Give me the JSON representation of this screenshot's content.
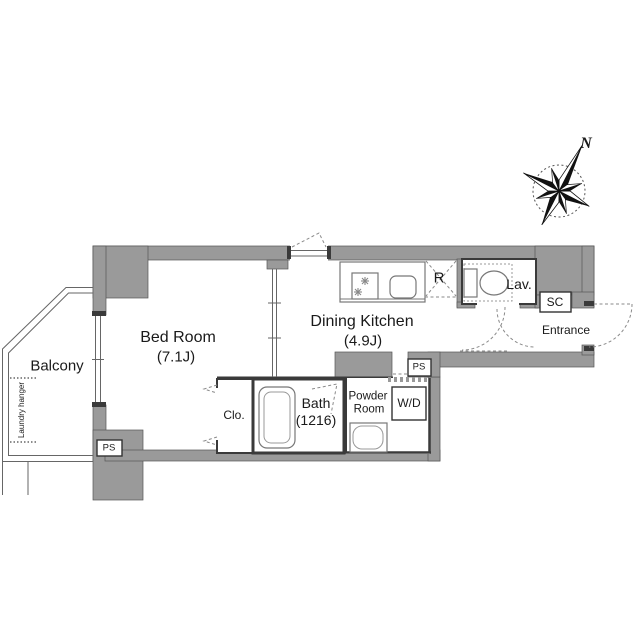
{
  "floorplan": {
    "rooms": {
      "bedroom": {
        "label": "Bed Room",
        "size": "(7.1J)"
      },
      "dining_kitchen": {
        "label": "Dining Kitchen",
        "size": "(4.9J)"
      },
      "bath": {
        "label": "Bath",
        "size": "(1216)"
      },
      "powder_room": {
        "label_line1": "Powder",
        "label_line2": "Room"
      },
      "balcony": {
        "label": "Balcony"
      },
      "lavatory": {
        "label": "Lav."
      },
      "entrance": {
        "label": "Entrance"
      },
      "closet": {
        "label": "Clo."
      }
    },
    "fixtures": {
      "washer_dryer": "W/D",
      "refrigerator": "R",
      "shoe_cabinet": "SC",
      "pipe_space": "PS",
      "laundry_hanger": "Laundry hanger"
    },
    "compass": {
      "north": "N"
    },
    "colors": {
      "wall": "#9a9a9a",
      "wall_edge": "#555555",
      "dark_line": "#3a3a3a",
      "fixture_line": "#777777",
      "text": "#1a1a1a"
    }
  }
}
